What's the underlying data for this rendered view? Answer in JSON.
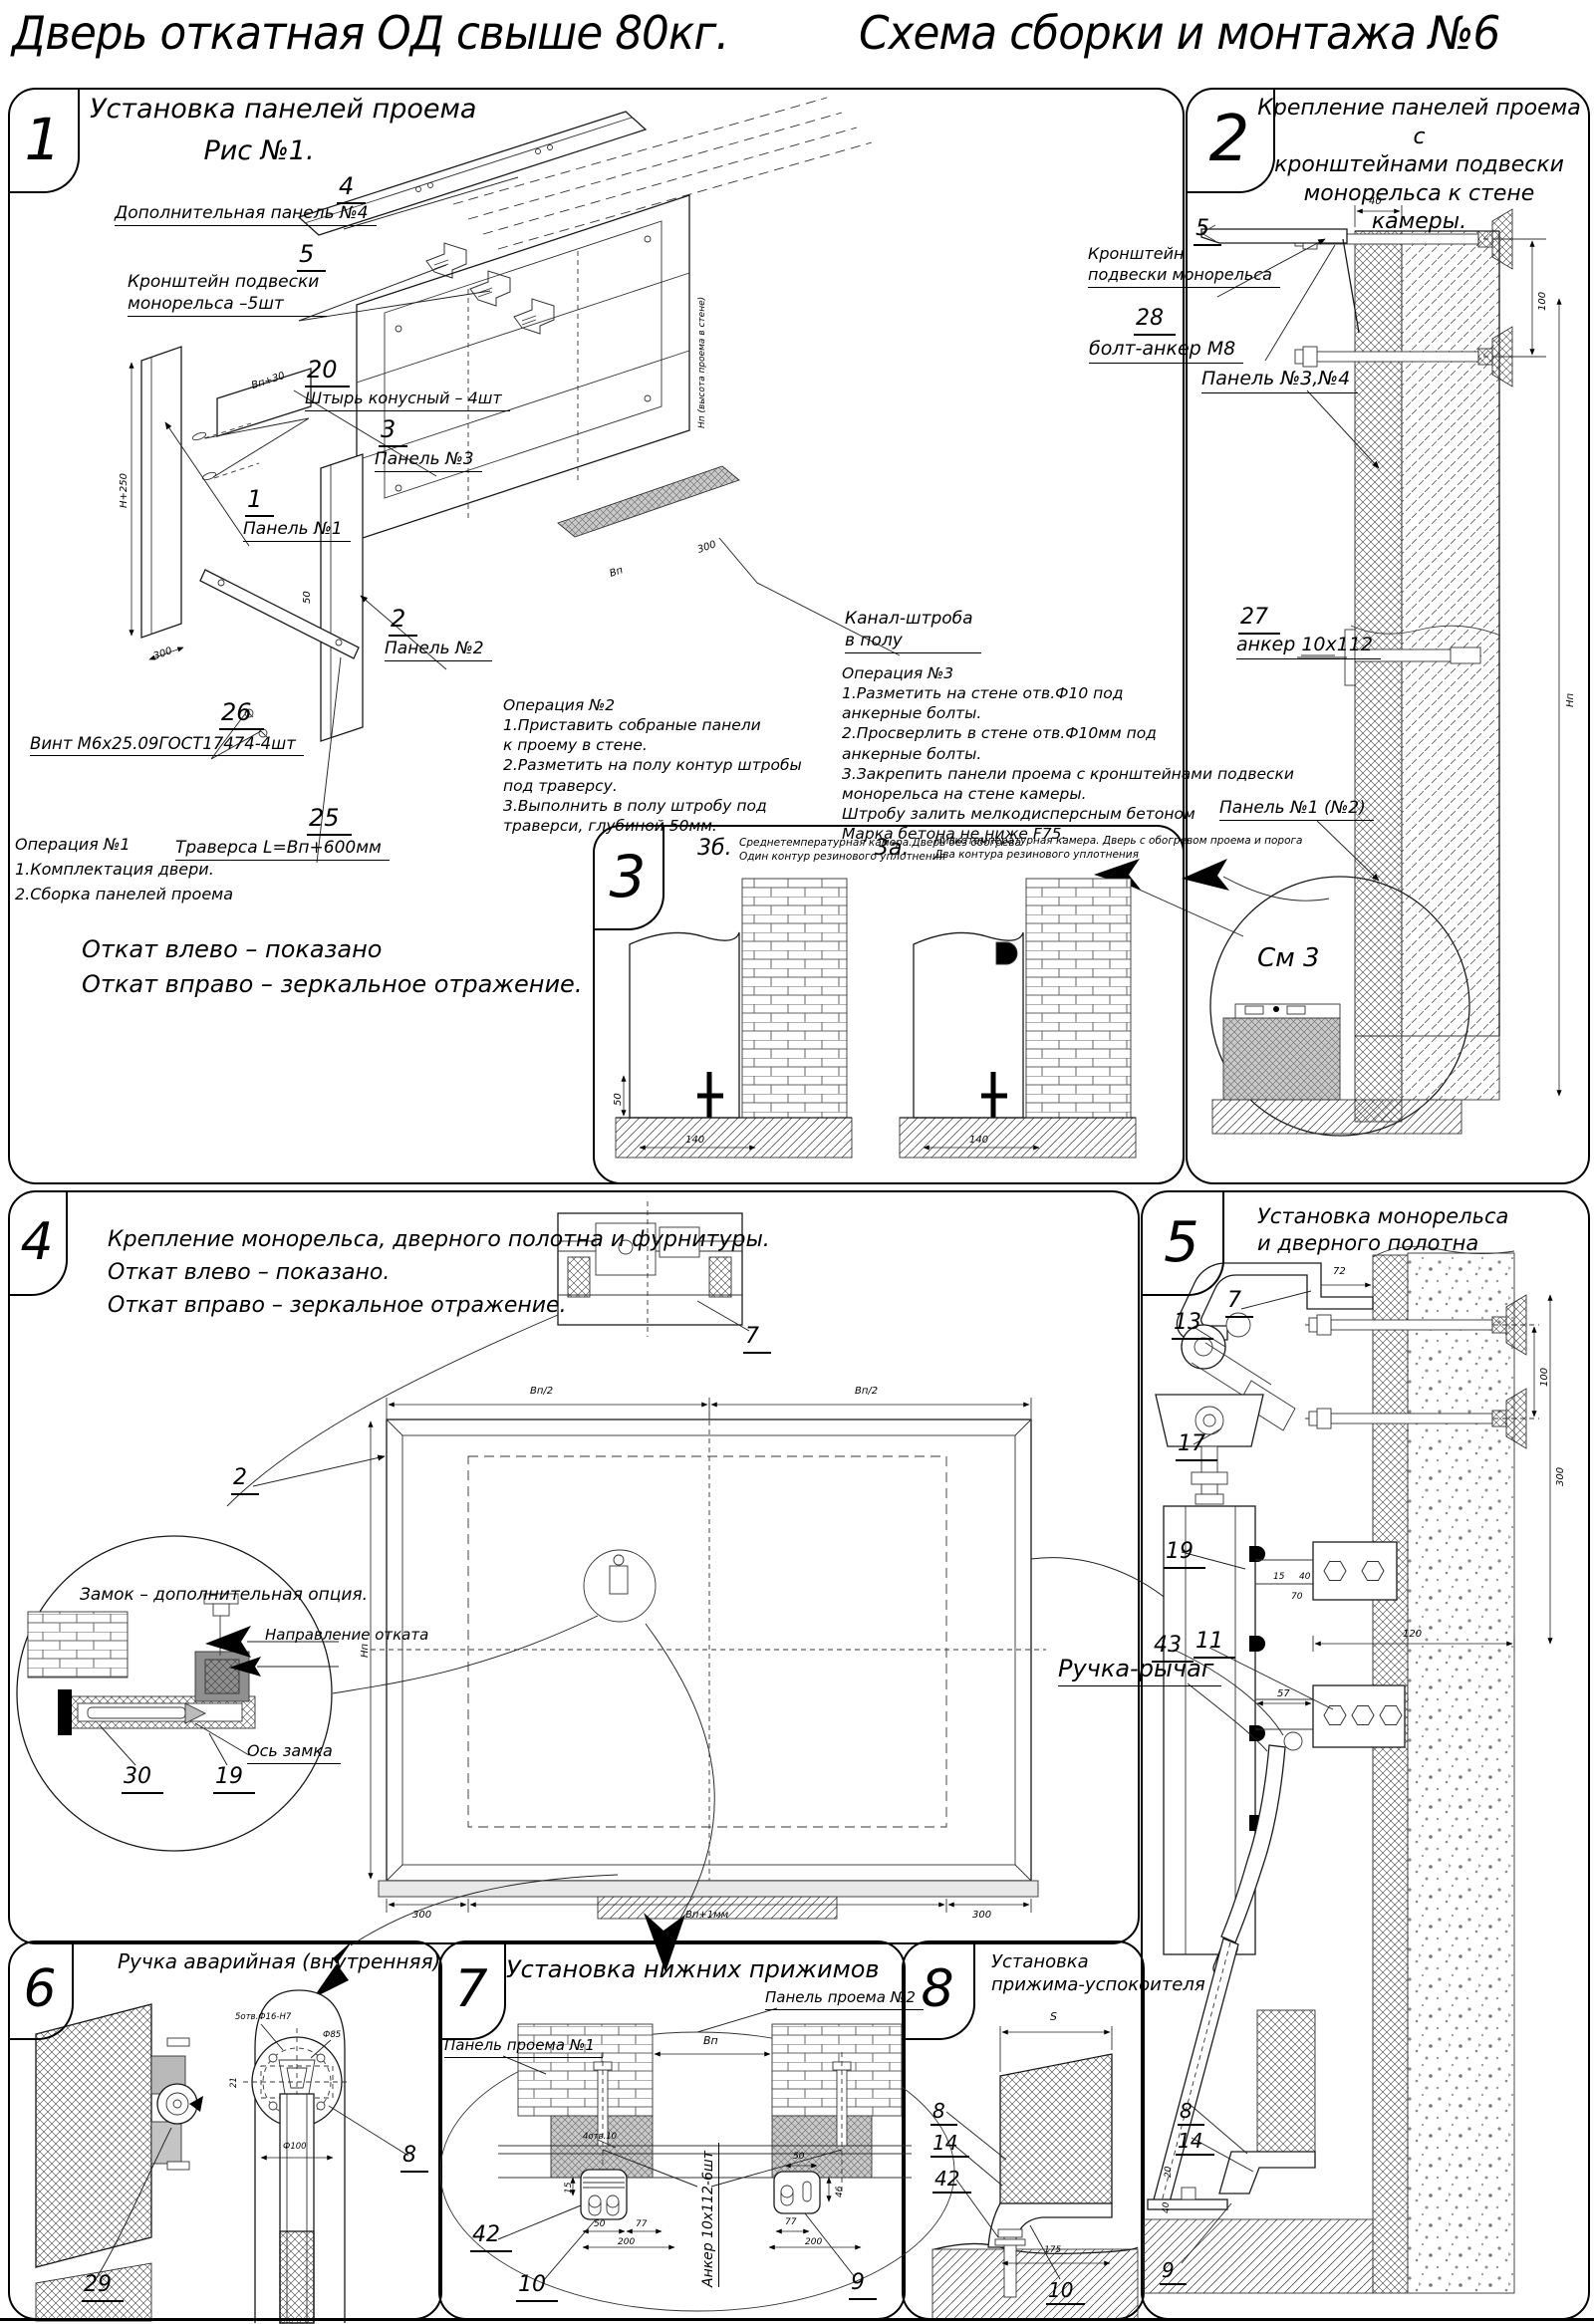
{
  "page": {
    "title_left": "Дверь откатная ОД свыше 80кг.",
    "title_right": "Схема сборки и монтажа №6"
  },
  "p1": {
    "num": "1",
    "title": "Установка панелей проема",
    "subtitle": "Рис №1.",
    "lbl4_n": "4",
    "lbl4": "Дополнительная панель №4",
    "lbl5_n": "5",
    "lbl5": "Кронштейн подвески\nмонорельса –5шт",
    "lbl20_n": "20",
    "lbl20": "Штырь конусный – 4шт",
    "lbl3_n": "3",
    "lbl3": "Панель №3",
    "lbl1_n": "1",
    "lbl1": "Панель №1",
    "lbl2_n": "2",
    "lbl2": "Панель №2",
    "lbl26_n": "26",
    "lbl26": "Винт М6х25.09ГОСТ17474-4шт",
    "lbl25_n": "25",
    "lbl25": "Траверса  L=Вп+600мм",
    "kanal": "Канал-штроба\nв полу",
    "op1": "Операция №1\n1.Комплектация двери.\n2.Сборка панелей проема",
    "op2": "Операция №2\n1.Приставить собраные панели\nк проему в стене.\n2.Разметить на полу контур штробы\nпод траверсу.\n3.Выполнить в полу штробу под\nтраверси, глубиной 50мм.",
    "op3": "Операция №3\n1.Разметить на стене отв.Ф10 под\nанкерные болты.\n2.Просверлить в стене отв.Ф10мм  под\nанкерные болты.\n3.Закрепить панели проема с кронштейнами подвески\nмонорельса на стене камеры.\nШтробу залить мелкодисперсным бетоном\nМарка бетона не ниже  F75.",
    "note": "Откат влево – показано\nОткат вправо – зеркальное отражение.",
    "dims": {
      "h250": "Н+250",
      "d300a": "300",
      "vp30": "Вп+30",
      "d50": "50",
      "np": "Нп (высота проема в стене)",
      "vp": "Вп",
      "d300b": "300"
    }
  },
  "p2": {
    "num": "2",
    "title": "Крепление панелей проема с\nкронштейнами  подвески\nмонорельса к стене камеры.",
    "lbl5_n": "5",
    "lbl5": "Кронштейн\nподвески монорельса",
    "lbl28_n": "28",
    "lbl28": "болт-анкер М8",
    "lbl34": "Панель №3,№4",
    "lbl27_n": "27",
    "lbl27": "анкер 10х112",
    "lbl12": "Панель №1 (№2)",
    "see3": "См 3",
    "dims": {
      "d40": "40",
      "d100": "100",
      "np": "Нп"
    }
  },
  "p3": {
    "num": "3",
    "b_n": "3б.",
    "b": "Среднетемпературная камера.Дверь без обогрева\nОдин контур резинового уплотнения",
    "a_n": "3а.",
    "a": "Низкотемпературная камера. Дверь с обогревом проема и порога\nДва контура резинового уплотнения",
    "dims": {
      "d140": "140",
      "d50": "50"
    }
  },
  "p4": {
    "num": "4",
    "title": "Крепление монорельса, дверного полотна и фурнитуры.\nОткат влево – показано.\nОткат вправо – зеркальное отражение.",
    "lbl7": "7",
    "lbl2": "2",
    "lbl30": "30",
    "lbl19": "19",
    "lock_note": "Замок – дополнительная опция.",
    "dir": "Направление отката",
    "axis": "Ось замка",
    "dims": {
      "vp2a": "Вп/2",
      "vp2b": "Вп/2",
      "np": "Нп",
      "d300a": "300",
      "vpc": "Вп+1мм",
      "d300b": "300"
    }
  },
  "p5": {
    "num": "5",
    "title": "Установка монорельса\nи дверного полотна",
    "lbl7": "7",
    "lbl13": "13",
    "lbl17": "17",
    "lbl19": "19",
    "lbl43": "43",
    "lbl11": "11",
    "handle": "Ручка-рычаг",
    "dims": {
      "d72": "72",
      "d100": "100",
      "d300": "300",
      "d120": "120",
      "d57": "57",
      "d15": "15",
      "d40": "40",
      "d70": "70"
    }
  },
  "p6": {
    "num": "6",
    "title": "Ручка аварийная (внутренняя)",
    "lbl8": "8",
    "lbl29": "29",
    "dims": {
      "sotv": "5отв.Ф16-Н7",
      "f85": "Ф85",
      "d21": "21",
      "f100": "Ф100"
    }
  },
  "p7": {
    "num": "7",
    "title": "Установка  нижних  прижимов",
    "panel2": "Панель проема №2",
    "panel1": "Панель проема №1",
    "lbl42": "42",
    "lbl10": "10",
    "lbl9": "9",
    "anchor": "Анкер  10х112-6шт",
    "dims": {
      "vp": "Вп",
      "otv": "4отв.10",
      "d50": "50",
      "d77": "77",
      "d200": "200",
      "d15": "15",
      "d46": "46"
    }
  },
  "p8": {
    "num": "8",
    "title": "Установка\nприжима-успокоителя",
    "lbl8": "8",
    "lbl14": "14",
    "lbl42": "42",
    "lbl10": "10",
    "lbl9": "9",
    "dims": {
      "s": "S",
      "d175": "175",
      "d20": "20",
      "d40": "40"
    }
  }
}
